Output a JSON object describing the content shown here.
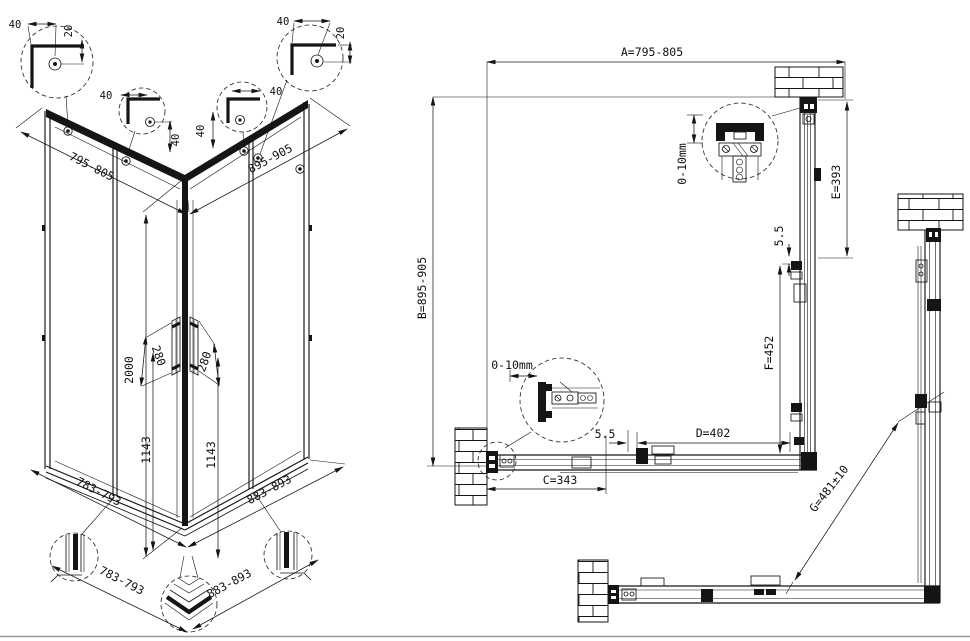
{
  "drawing": {
    "background": "#ffffff",
    "line_color": "#151515",
    "iso": {
      "d795": "795-805",
      "d895": "895-905",
      "d2000": "2000",
      "d1143a": "1143",
      "d1143b": "1143",
      "d280a": "280",
      "d280b": "280",
      "d783a": "783-793",
      "d883a": "883-893",
      "d783b": "783-793",
      "d883b": "883-893",
      "c1w": "40",
      "c1h": "20",
      "c2w": "40",
      "c2h": "40",
      "c3w": "40",
      "c3h": "40",
      "c4w": "40",
      "c4h": "20"
    },
    "plan": {
      "a": "A=795-805",
      "b": "B=895-905",
      "e": "E=393",
      "f": "F=452",
      "c": "C=343",
      "d": "D=402",
      "g": "G=481±10",
      "gap_r": "5.5",
      "gap_b": "5.5",
      "adj_t": "0-10mm",
      "adj_l": "0-10mm"
    }
  }
}
